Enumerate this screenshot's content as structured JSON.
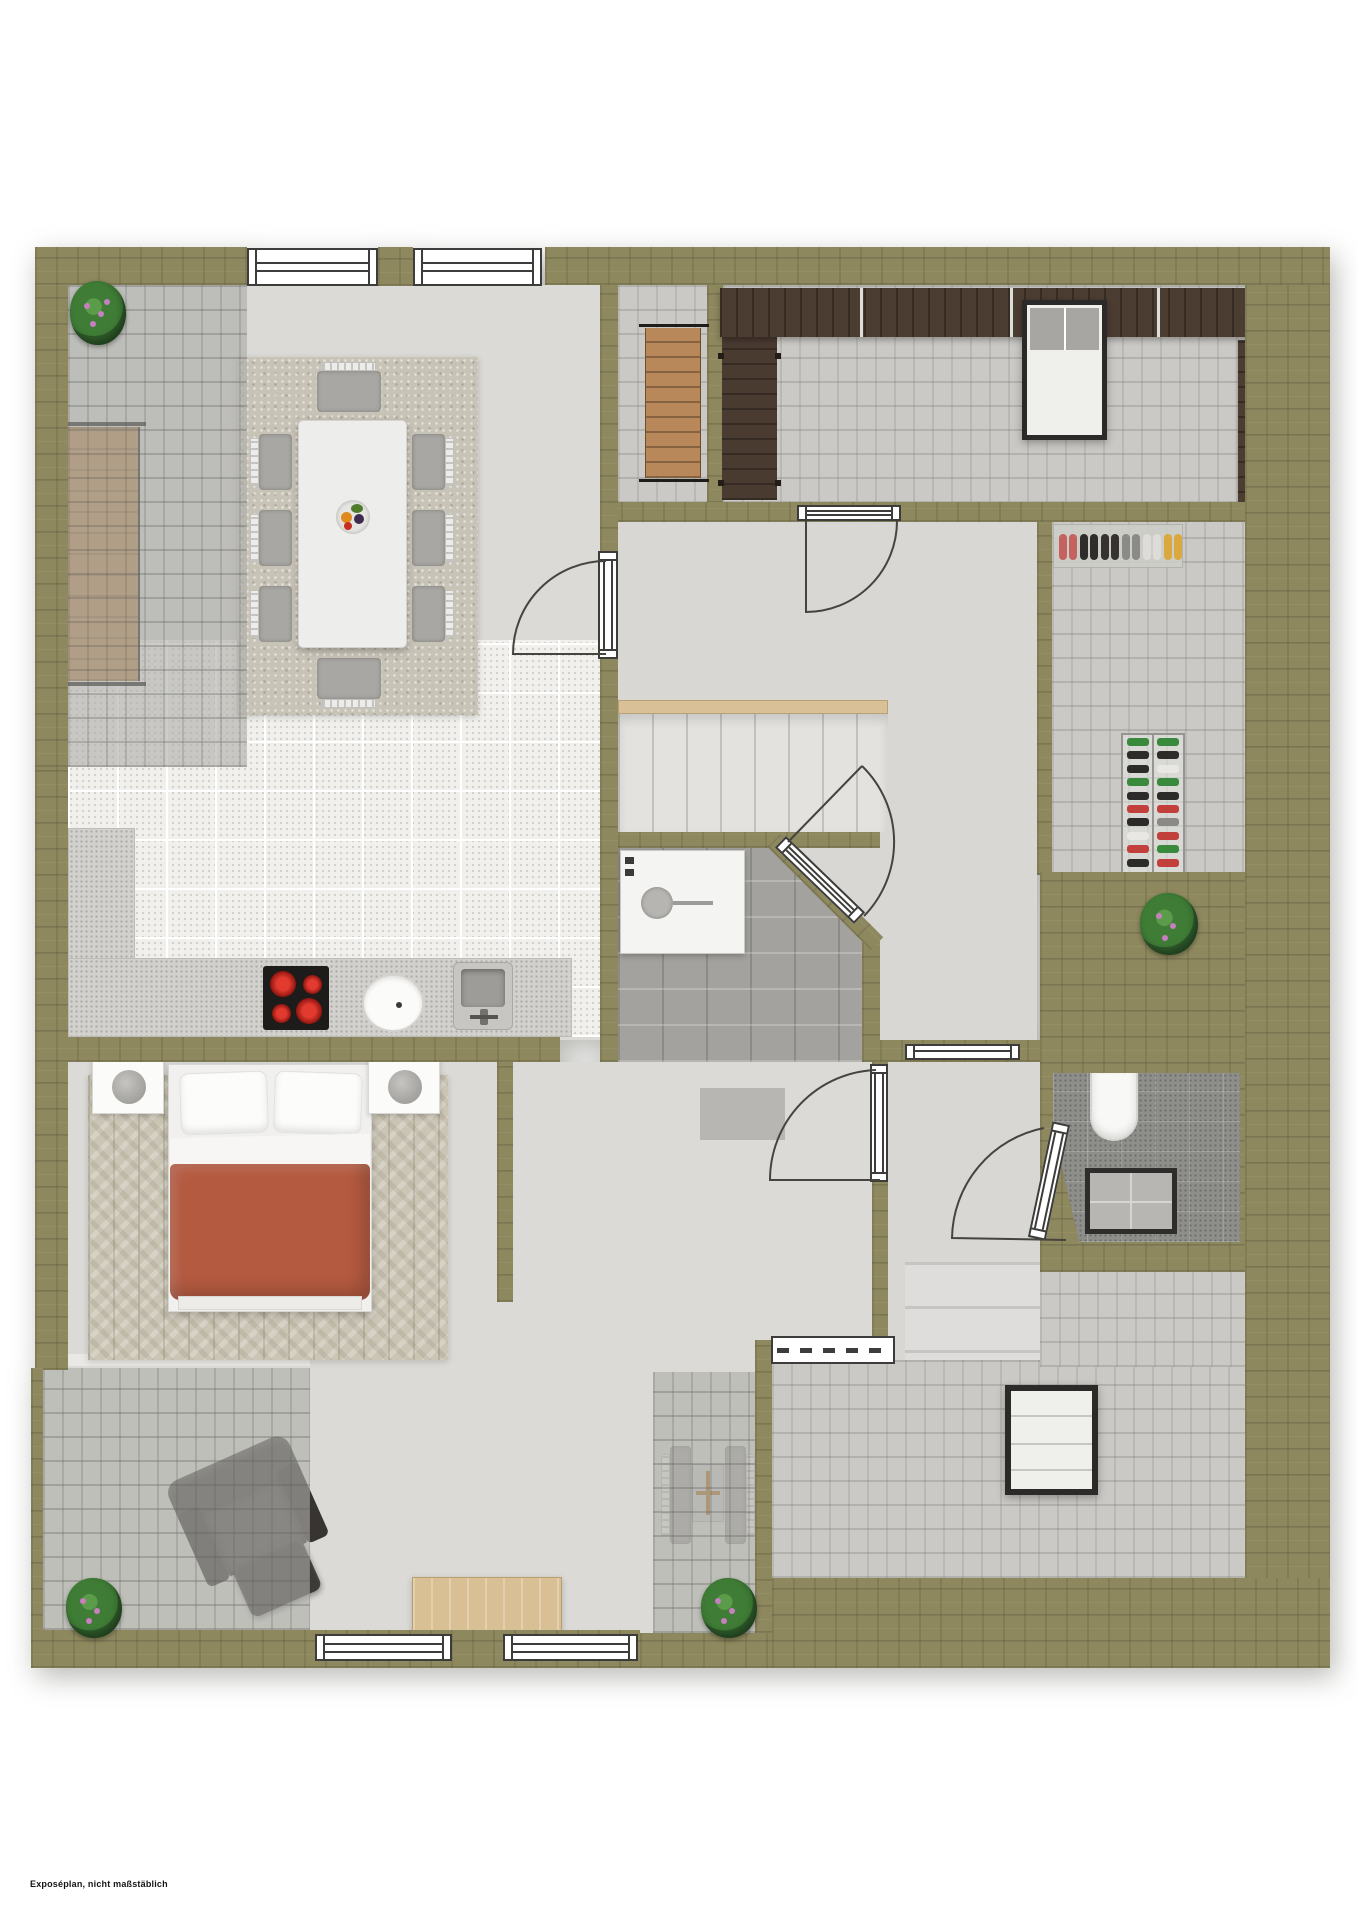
{
  "footer": {
    "note": "Exposéplan, nicht maßstäblich"
  },
  "palette": {
    "olive": "#8d885e",
    "roof-grey": "#cac9c5",
    "floor": "#dbdad6",
    "floor-hall": "#d8d7d3",
    "kitchen-tile": "#f1f0ec",
    "counter": "#d2d1cd",
    "stone": "#a3a29e",
    "bath-tile": "#8e8e8b",
    "wood-rail": "#d9c096",
    "wood-bench": "#b5854f",
    "wood-side": "#d9c094",
    "lounge-dark": "#4a3b31",
    "lounge-light": "#b9885a",
    "pergola": "#4c3d32",
    "duvet": "#b45a40",
    "chair-grey": "#a8a7a3",
    "sofa-dark": "#413e3c",
    "plant-dark": "#2e5b2a",
    "plant-mid": "#3f7d36",
    "plant-light": "#5a9c4a",
    "flower-pink": "#c77fc0",
    "line": "#3c3c3a",
    "burner-red": "#cc1f1a",
    "cooktop-black": "#1d1c1b"
  },
  "shoe_mat": {
    "pairs": [
      "#c4625f",
      "#2f2d2c",
      "#35322f",
      "#8a8a88",
      "#dddcd8",
      "#d9a83f"
    ]
  },
  "shoe_rack": {
    "rows": [
      [
        "#3a8a3d",
        "#3a8a3d"
      ],
      [
        "#2c2b2a",
        "#2c2b2a"
      ],
      [
        "#2c2b2a",
        "#e8e7e3"
      ],
      [
        "#3a8a3d",
        "#3a8a3d"
      ],
      [
        "#2c2b2a",
        "#2c2b2a"
      ],
      [
        "#c2403c",
        "#c2403c"
      ],
      [
        "#2c2b2a",
        "#8b8a87"
      ],
      [
        "#e8e7e3",
        "#c2403c"
      ],
      [
        "#c2403c",
        "#3a8a3d"
      ],
      [
        "#2c2b2a",
        "#c2403c"
      ]
    ]
  }
}
